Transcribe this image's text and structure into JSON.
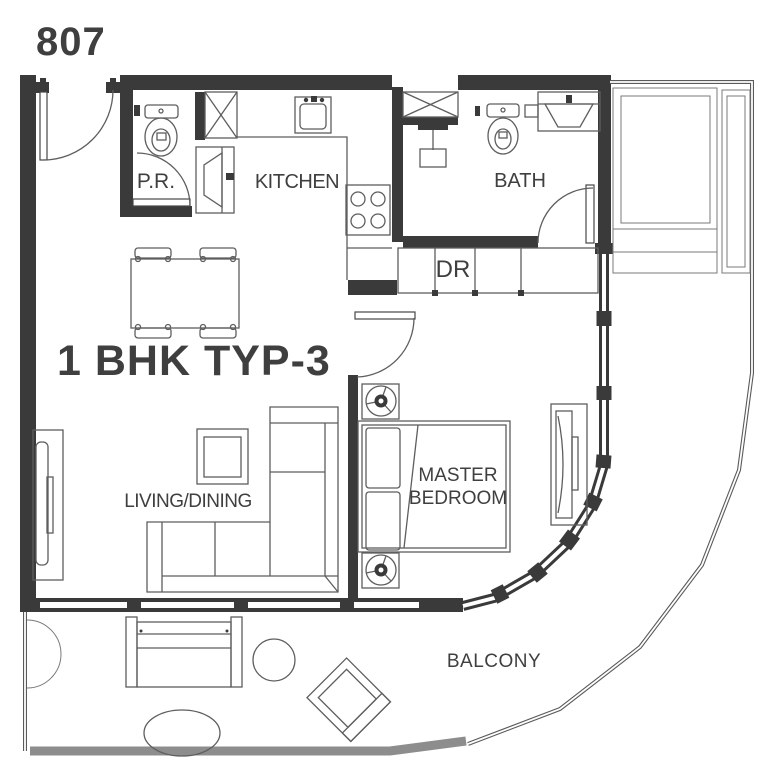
{
  "unit": {
    "number": "807",
    "plan_type": "1 BHK TYP-3"
  },
  "rooms": {
    "powder_room": "P.R.",
    "kitchen": "KITCHEN",
    "bath": "BATH",
    "dresser": "DR",
    "living_dining": "LIVING/DINING",
    "master_bedroom_line1": "MASTER",
    "master_bedroom_line2": "BEDROOM",
    "balcony": "BALCONY"
  },
  "colors": {
    "wall": "#3a3a3a",
    "furniture_line": "#5e5e5e",
    "thin_line": "#7a7a7a",
    "slab_edge": "#8d8d8d",
    "text": "#3f3f3f",
    "background": "#ffffff"
  }
}
